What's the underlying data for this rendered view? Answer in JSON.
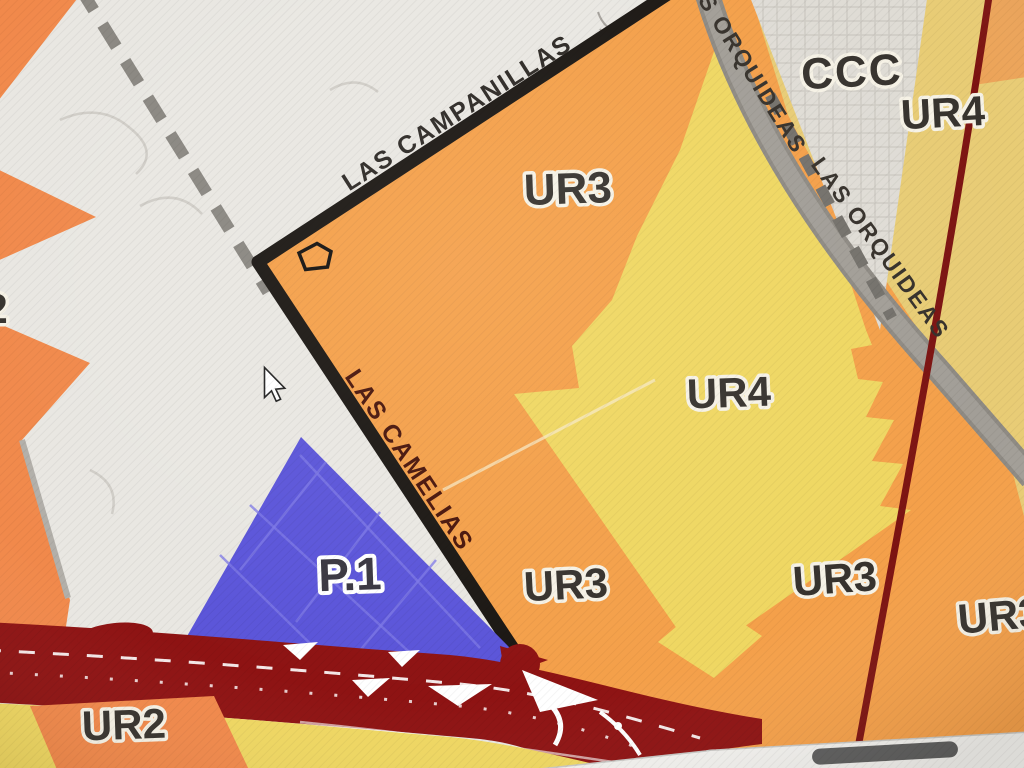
{
  "map": {
    "streets": {
      "campanillas": "LAS CAMPANILLAS",
      "camelias": "LAS CAMELIAS",
      "orquideas_upper": "LAS ORQUIDEAS",
      "orquideas_lower": "LAS ORQUIDEAS"
    },
    "zones": {
      "ur3_main": "UR3",
      "ur4_main": "UR4",
      "ur3_bottom_center": "UR3",
      "ur3_bottom_right": "UR3",
      "ur3_right_edge": "UR3",
      "ccc": "CCC",
      "ur4_top_right": "UR4",
      "p1": "P.1",
      "ur2": "UR2",
      "partial_2": "2"
    },
    "colors": {
      "bg_gray": "#e9e7e2",
      "zone_gray": "#dfdcd5",
      "orange": "#f1a04e",
      "orange_deep": "#ee8a4e",
      "orange_corner": "#eaa45c",
      "yellow": "#eed766",
      "tan": "#e7cc78",
      "blue": "#5b55d4",
      "highway": "#8a1414",
      "road_black": "#1b1713",
      "road_gray": "#a29e97",
      "road_gray_edge": "#8e8a83",
      "thin_red": "#7a1513"
    }
  },
  "ui": {
    "scrollbar_track": "#f2f1ee",
    "scrollbar_thumb": "#5e5e5e"
  }
}
